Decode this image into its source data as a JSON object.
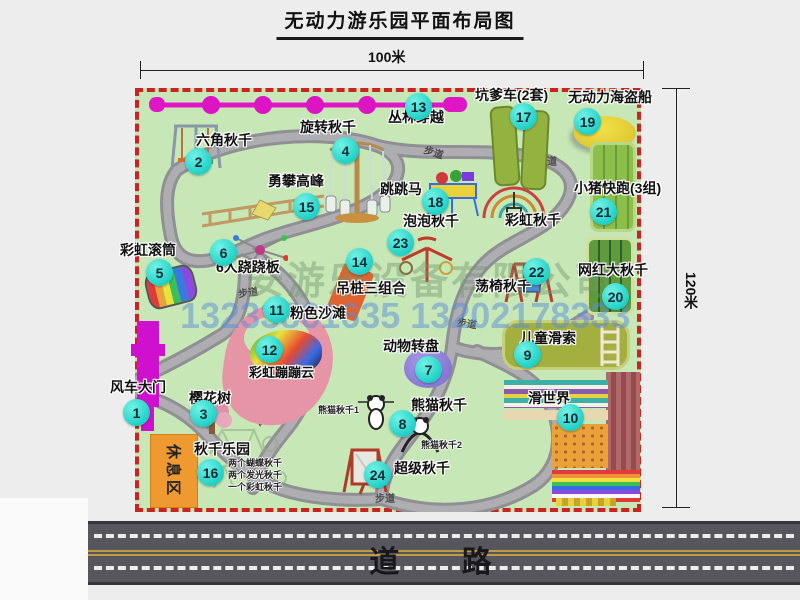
{
  "title": "无动力游乐园平面布局图",
  "dimensions": {
    "width": "100米",
    "height": "120米"
  },
  "road_label": "道 路",
  "footpath_label": "步道",
  "rest_area_label": "休息区",
  "watermark": {
    "company": "安游乐设备有限公司",
    "phone": "13233861635 13202178333"
  },
  "badges": {
    "b1": "1",
    "b2": "2",
    "b3": "3",
    "b4": "4",
    "b5": "5",
    "b6": "6",
    "b7": "7",
    "b8": "8",
    "b9": "9",
    "b10": "10",
    "b11": "11",
    "b12": "12",
    "b13": "13",
    "b14": "14",
    "b15": "15",
    "b16": "16",
    "b17": "17",
    "b18": "18",
    "b19": "19",
    "b20": "20",
    "b21": "21",
    "b22": "22",
    "b23": "23",
    "b24": "24"
  },
  "labels": {
    "l1": "风车大门",
    "l2": "六角秋千",
    "l3": "樱花树",
    "l4": "旋转秋千",
    "l5": "彩虹滚筒",
    "l6": "6人跷跷板",
    "l7": "动物转盘",
    "l8": "熊猫秋千",
    "l9": "儿童滑索",
    "l10": "滑世界",
    "l11": "粉色沙滩",
    "l12": "彩虹蹦蹦云",
    "l13": "丛林穿越",
    "l14": "吊桩三组合",
    "l15": "勇攀高峰",
    "l16": "秋千乐园",
    "l17": "坑爹车(2套)",
    "l18": "跳跳马",
    "l19": "无动力海盗船",
    "l20": "网红大秋千",
    "l21": "小猪快跑(3组)",
    "l22": "荡椅秋千",
    "l23": "泡泡秋千",
    "l24": "超级秋千",
    "rainbow_swing": "彩虹秋千",
    "panda1": "熊猫秋千1",
    "panda2": "熊猫秋千2",
    "note1": "两个蝴蝶秋千",
    "note2": "两个发光秋千",
    "note3": "一个彩虹秋千"
  }
}
